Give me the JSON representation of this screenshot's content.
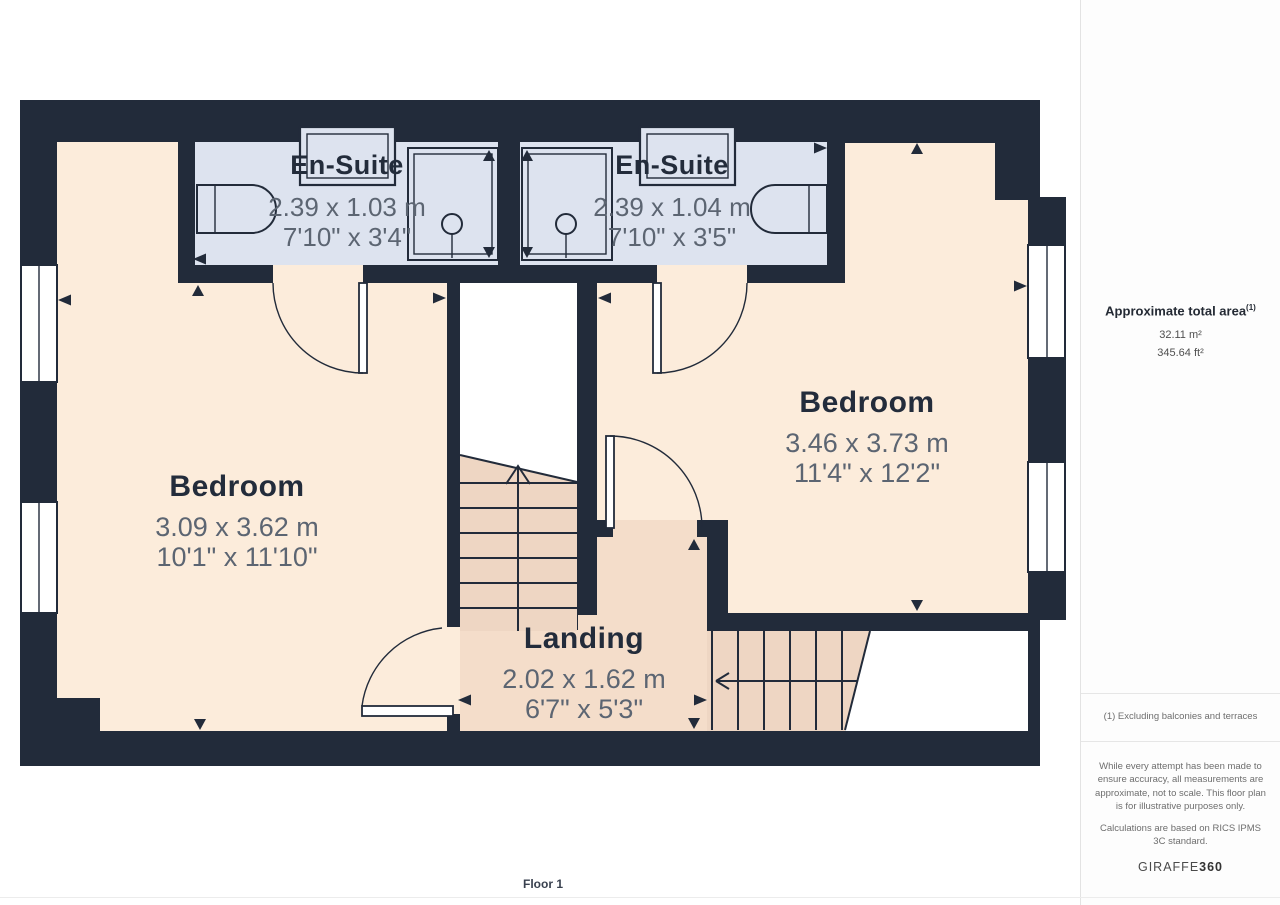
{
  "plan": {
    "floor_label": "Floor 1",
    "rooms": [
      {
        "key": "ensuite-left",
        "name": "En-Suite",
        "dims_m": "2.39 x 1.03 m",
        "dims_imperial": "7'10\" x 3'4\""
      },
      {
        "key": "ensuite-right",
        "name": "En-Suite",
        "dims_m": "2.39 x 1.04 m",
        "dims_imperial": "7'10\" x 3'5\""
      },
      {
        "key": "bedroom-left",
        "name": "Bedroom",
        "dims_m": "3.09 x 3.62 m",
        "dims_imperial": "10'1\" x 11'10\""
      },
      {
        "key": "bedroom-right",
        "name": "Bedroom",
        "dims_m": "3.46 x 3.73 m",
        "dims_imperial": "11'4\" x 12'2\""
      },
      {
        "key": "landing",
        "name": "Landing",
        "dims_m": "2.02 x 1.62 m",
        "dims_imperial": "6'7\" x 5'3\""
      }
    ],
    "colors": {
      "wall": "#222b3a",
      "bedroom_floor": "#fcecdb",
      "ensuite_floor": "#dde3ef",
      "landing_floor": "#f4ddca",
      "stairs": "#eed6c3",
      "label": "#232c3b",
      "dims": "#5c6572"
    }
  },
  "sidebar": {
    "area_title": "Approximate total area",
    "area_footnote_marker": "(1)",
    "area_metric": "32.11 m²",
    "area_imperial": "345.64 ft²",
    "footnote": "(1) Excluding balconies and terraces",
    "disclaimer": "While every attempt has been made to ensure accuracy, all measurements are approximate, not to scale. This floor plan is for illustrative purposes only.",
    "standards_note": "Calculations are based on RICS IPMS 3C standard.",
    "brand": "GIRAFFE",
    "brand_bold": "360"
  }
}
